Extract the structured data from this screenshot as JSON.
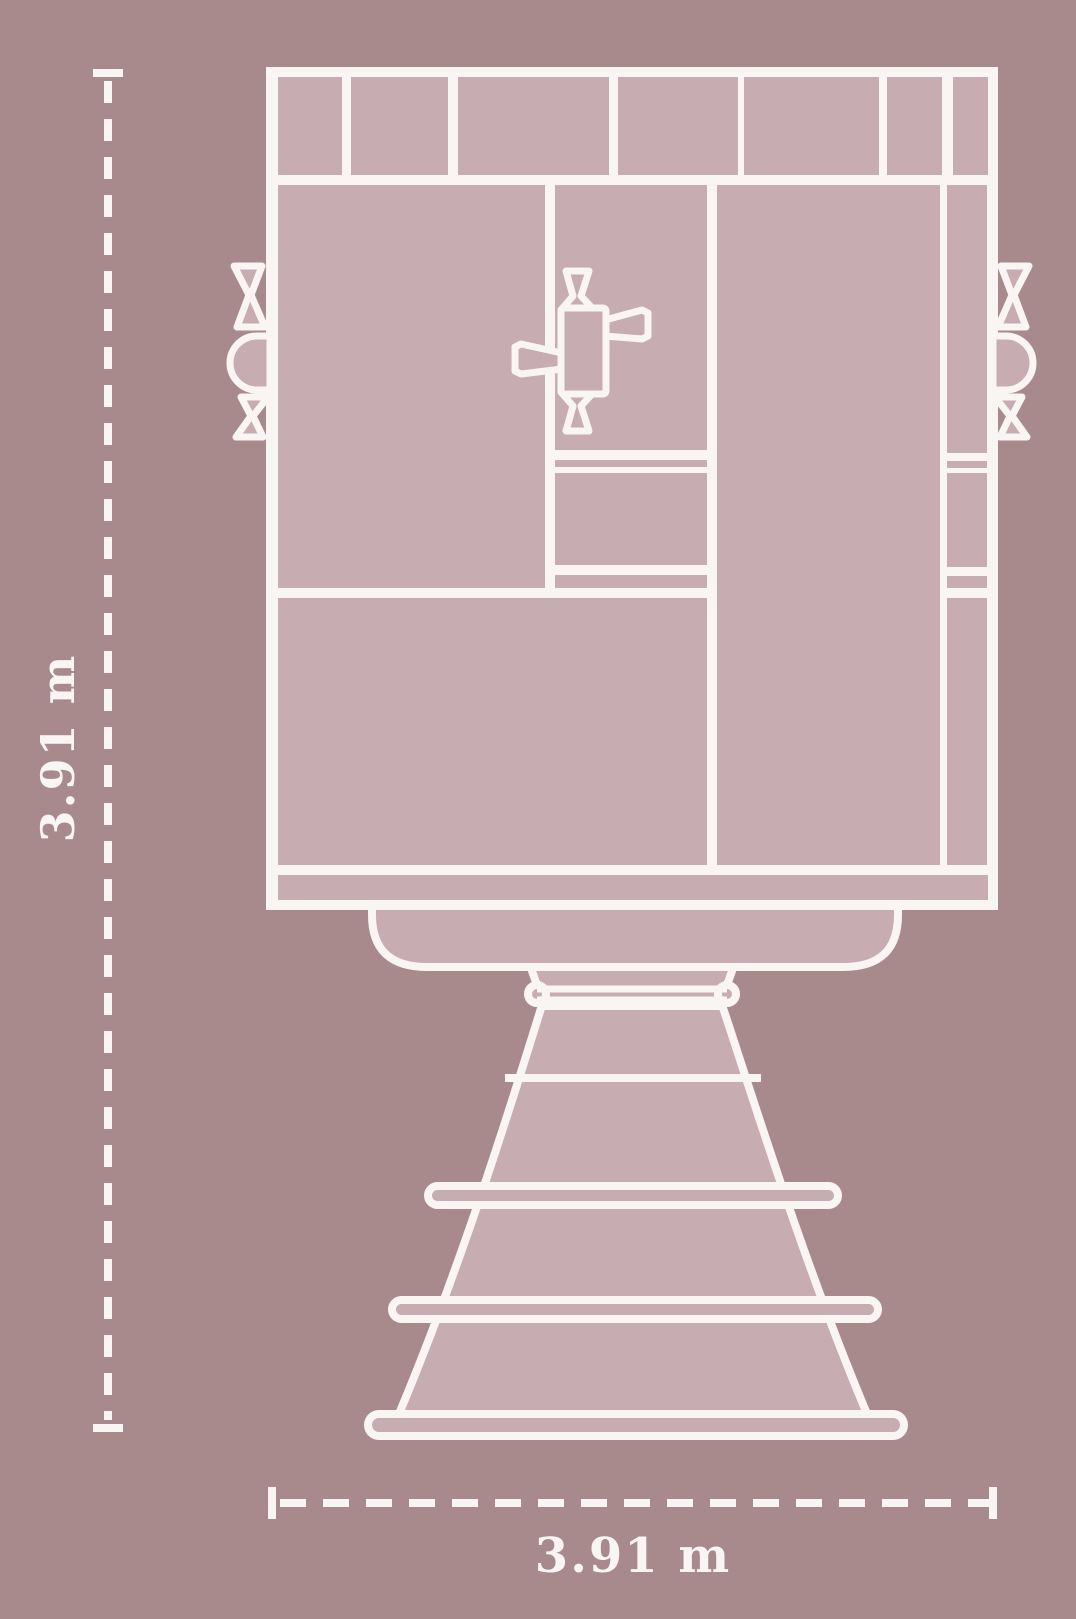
{
  "title": "Rocket engine dimensional diagram",
  "dimensions": {
    "height_label": "3.91 m",
    "width_label": "3.91 m"
  },
  "colors": {
    "background": "#a98a8c",
    "panel": "#c7acb1",
    "line": "#f9f5f2"
  }
}
